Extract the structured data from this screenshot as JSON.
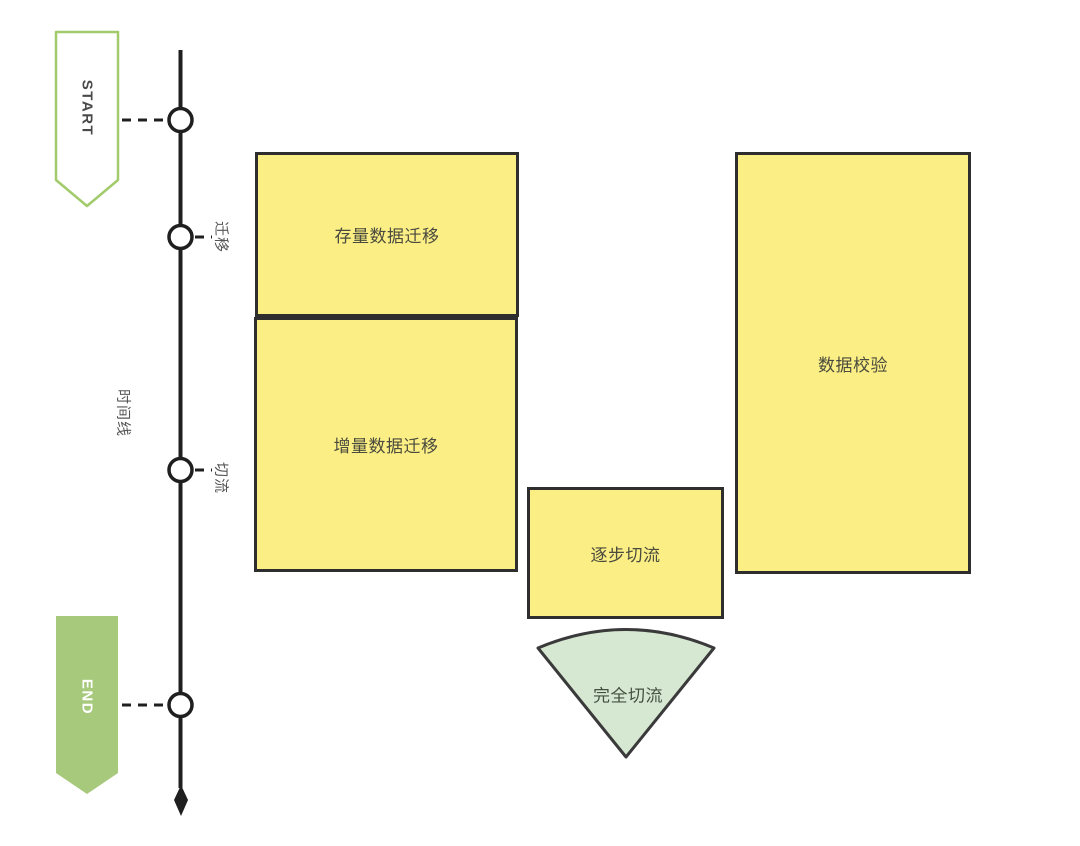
{
  "colors": {
    "activity-fill": "#FAEE85",
    "shape-border": "#2E2E2E",
    "funnel-fill": "#D6E8D2",
    "funnel-border": "#3A3A3A",
    "start-border": "#A2CB6C",
    "end-fill": "#A6C97B",
    "timeline-line": "#1F1F1F"
  },
  "timeline": {
    "axis_label": "时间线",
    "start": {
      "label": "START"
    },
    "end": {
      "label": "END"
    },
    "milestones": [
      {
        "label": "迁移"
      },
      {
        "label": "切流"
      }
    ]
  },
  "activities": [
    {
      "label": "存量数据迁移"
    },
    {
      "label": "增量数据迁移"
    },
    {
      "label": "逐步切流"
    },
    {
      "label": "数据校验"
    }
  ],
  "funnel": {
    "label": "完全切流"
  }
}
